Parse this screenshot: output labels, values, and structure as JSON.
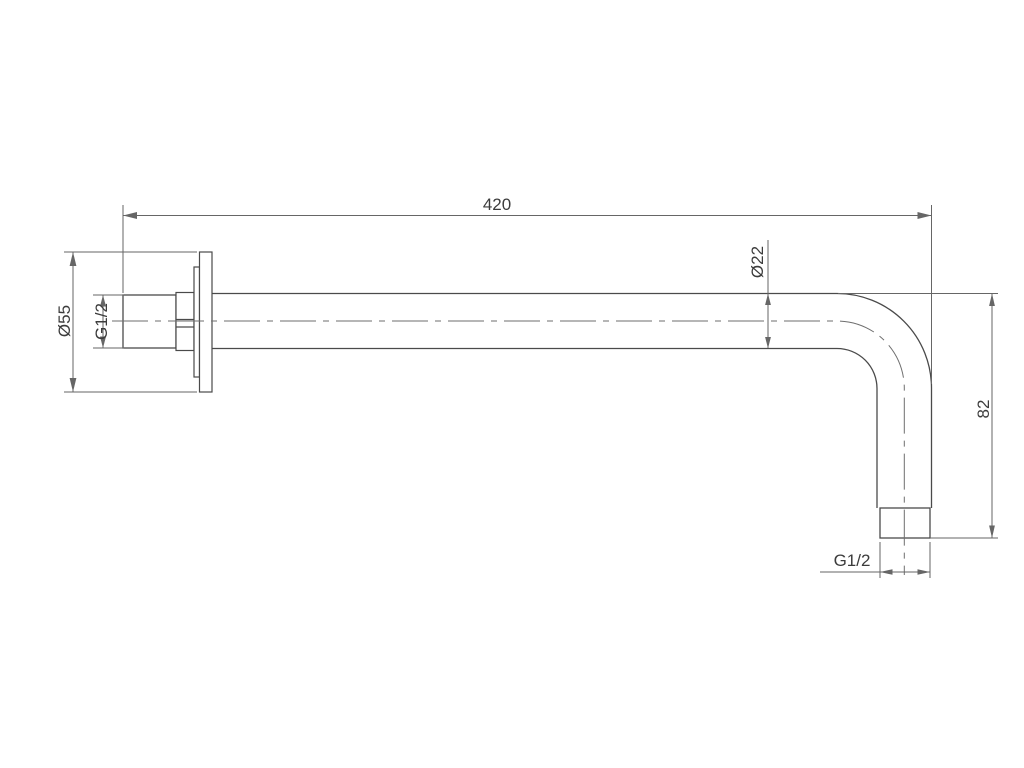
{
  "drawing": {
    "type": "technical-dimension-drawing",
    "subject": "wall-mounted shower arm, side view",
    "dimensions": {
      "overall_length": "420",
      "flange_diameter": "Ø55",
      "wall_thread": "G1/2",
      "pipe_diameter": "Ø22",
      "outlet_drop": "82",
      "outlet_thread": "G1/2"
    },
    "colors": {
      "background": "#ffffff",
      "object_line": "#4a4a4a",
      "dimension_line": "#666666",
      "text": "#3c3c3c",
      "thread_dark": "#1f1f1f",
      "thread_light": "#9a9a9a"
    }
  }
}
